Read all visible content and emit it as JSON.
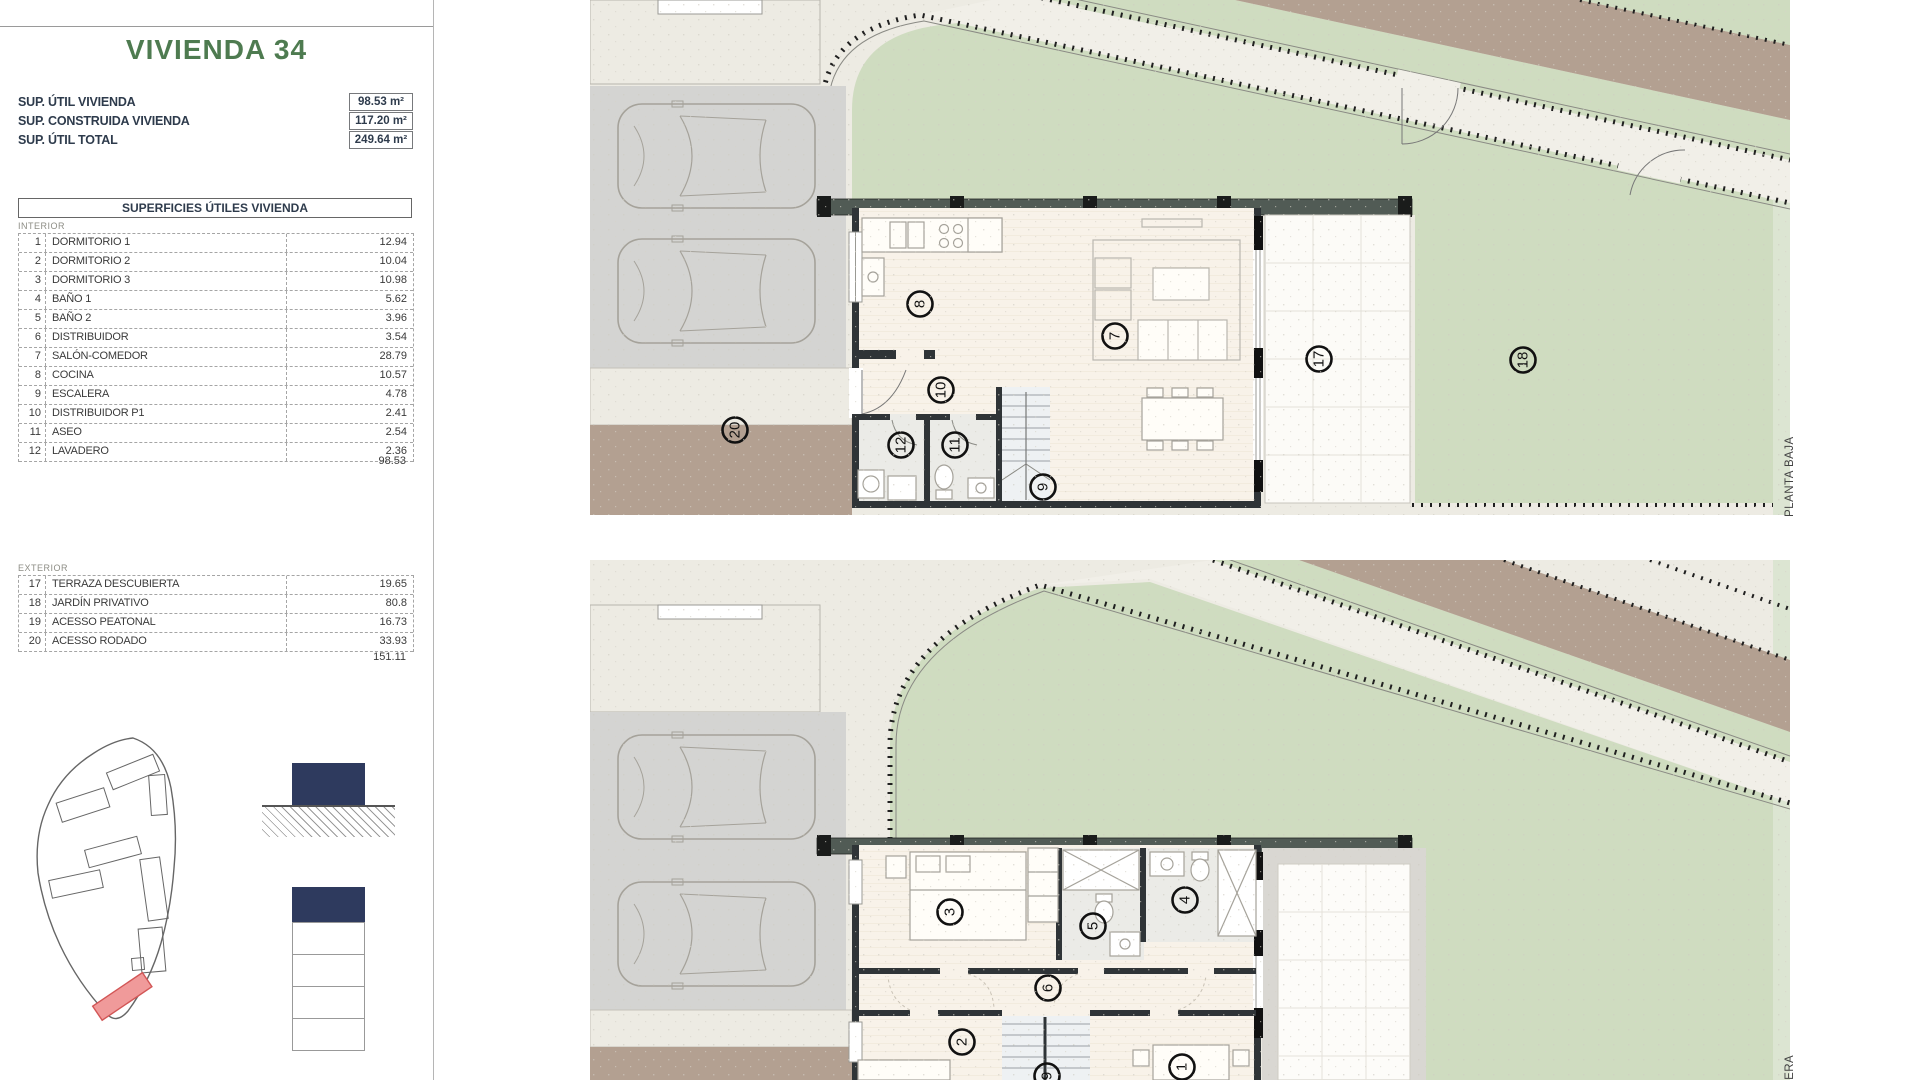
{
  "panel": {
    "title": "VIVIENDA 34",
    "summary": [
      {
        "label": "SUP. ÚTIL VIVIENDA",
        "value": "98.53 m²"
      },
      {
        "label": "SUP. CONSTRUIDA VIVIENDA",
        "value": "117.20 m²"
      },
      {
        "label": "SUP. ÚTIL TOTAL",
        "value": "249.64 m²"
      }
    ],
    "table": {
      "header": "SUPERFICIES ÚTILES VIVIENDA",
      "interior_label": "INTERIOR",
      "interior_rows": [
        {
          "num": "1",
          "name": "DORMITORIO 1",
          "value": "12.94"
        },
        {
          "num": "2",
          "name": "DORMITORIO 2",
          "value": "10.04"
        },
        {
          "num": "3",
          "name": "DORMITORIO 3",
          "value": "10.98"
        },
        {
          "num": "4",
          "name": "BAÑO 1",
          "value": "5.62"
        },
        {
          "num": "5",
          "name": "BAÑO 2",
          "value": "3.96"
        },
        {
          "num": "6",
          "name": "DISTRIBUIDOR",
          "value": "3.54"
        },
        {
          "num": "7",
          "name": "SALÓN-COMEDOR",
          "value": "28.79"
        },
        {
          "num": "8",
          "name": "COCINA",
          "value": "10.57"
        },
        {
          "num": "9",
          "name": "ESCALERA",
          "value": "4.78"
        },
        {
          "num": "10",
          "name": "DISTRIBUIDOR P1",
          "value": "2.41"
        },
        {
          "num": "11",
          "name": "ASEO",
          "value": "2.54"
        },
        {
          "num": "12",
          "name": "LAVADERO",
          "value": "2.36"
        }
      ],
      "interior_total": "98.53",
      "exterior_label": "EXTERIOR",
      "exterior_rows": [
        {
          "num": "17",
          "name": "TERRAZA DESCUBIERTA",
          "value": "19.65"
        },
        {
          "num": "18",
          "name": "JARDÍN PRIVATIVO",
          "value": "80.8"
        },
        {
          "num": "19",
          "name": "ACESSO PEATONAL",
          "value": "16.73"
        },
        {
          "num": "20",
          "name": "ACESSO RODADO",
          "value": "33.93"
        }
      ],
      "exterior_total": "151.11"
    }
  },
  "plans": {
    "ground": {
      "label": "PLANTA BAJA",
      "markers": {
        "salon": "7",
        "cocina": "8",
        "escalera": "9",
        "distribuidor": "10",
        "aseo": "11",
        "lavadero": "12",
        "terraza": "17",
        "jardin": "18",
        "acesso_rodado": "20"
      }
    },
    "first": {
      "label_visible": "MERA",
      "markers": {
        "dormitorio1": "1",
        "dormitorio2": "2",
        "dormitorio3": "3",
        "bano1": "4",
        "bano2": "5",
        "distribuidor": "6",
        "escalera": "9"
      }
    }
  },
  "colors": {
    "title_green": "#4e7b50",
    "table_text": "#2e3b4c",
    "accent_navy": "#2e3a5e",
    "plot_red": "#f09a9a",
    "lawn_green": "#cfdcc0",
    "path_brown": "#b3a091",
    "wall_dark": "#2f3437"
  }
}
